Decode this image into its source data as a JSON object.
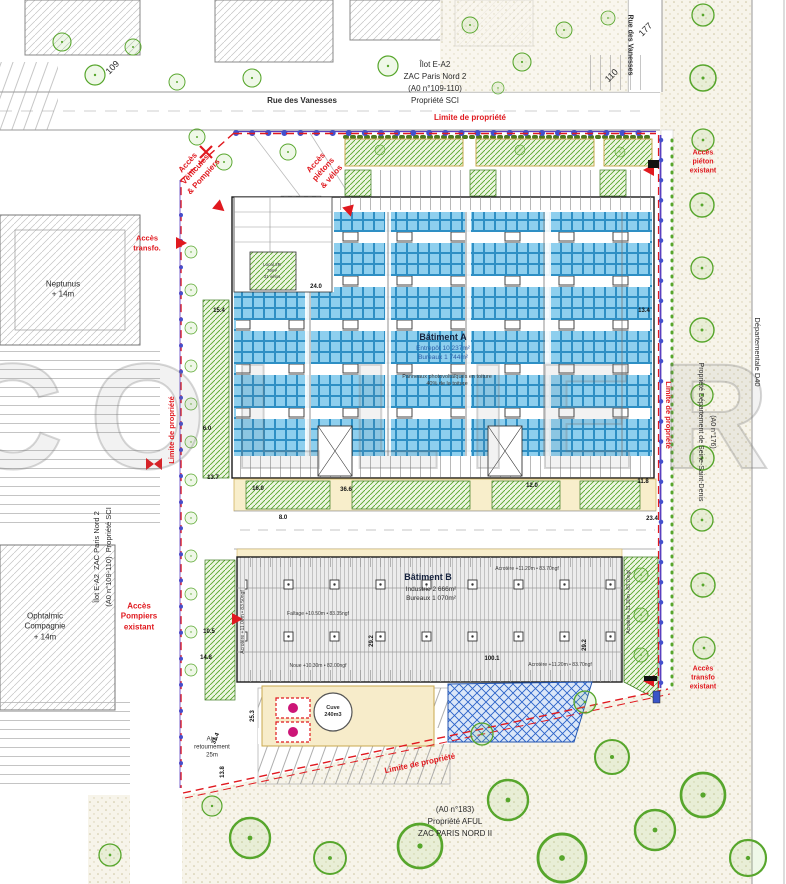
{
  "watermark": {
    "text": "COLLIERS ®"
  },
  "streets": {
    "rue_top": "Rue des Vanesses",
    "rue_right": "Rue des Vanesses",
    "departementale": "Départementale D40",
    "n109": "109",
    "n110": "110",
    "n177": "177"
  },
  "parcels": {
    "top": "Îlot E-A2\nZAC Paris Nord 2\n(A0 n°109-110)\nPropriété SCI",
    "left": "Îlot E-A2  ZAC Paris Nord 2\n(A0 n°109-110)  Propriété SCI",
    "right": "(A0 n°176)\nPropriété Département de Seine-Saint-Denis",
    "bottom": "(A0 n°183)\nPropriété AFUL\nZAC PARIS NORD II"
  },
  "limits": {
    "label": "Limite de propriété"
  },
  "access": {
    "vehicles": "Accès\nVéhicules\n& Pompiers",
    "pietons": "Accès\npiétons\n& vélos",
    "transfo": "Accès\ntransfo.",
    "pompiers": "Accès\nPompiers\nexistant",
    "pieton_existant": "Accès\npiéton\nexistant",
    "transfo_existant": "Accès\ntransfo\nexistant"
  },
  "context": {
    "neptunus": "Neptunus\n+ 14m",
    "ophtalmic": "Ophtalmic\nCompagnie\n+ 14m"
  },
  "building_a": {
    "name": "Bâtiment A",
    "line2": "Entrepôt 10 237m²",
    "line3": "Bureaux 1 744m²",
    "pv": "Panneaux photovoltaïques en toiture\n40% de la toiture"
  },
  "building_b": {
    "name": "Bâtiment B",
    "line2": "Industrie 2 666m²",
    "line3": "Bureaux 1 070m²"
  },
  "annotations": {
    "acrotere": "Acrotère +11.20m • 83.70ngf",
    "acrotere_left": "Acrotère +11.00m • 83.50ngf",
    "faitage": "Faîtage +10.50m • 83.35ngf",
    "noue": "Noue +10.30m • 82.00ngf"
  },
  "site": {
    "local_velos": "Local 2R\n79m²\n31 vélos",
    "aire": "Aire\nretournement\n25m",
    "cuve": "Cuve\n240m3"
  },
  "dims": {
    "v15_4": "15.4",
    "v13_4": "13.4",
    "v24_0": "24.0",
    "v6_0": "6.0",
    "v13_7": "13.7",
    "v16_0": "16.0",
    "v36_6": "36.6",
    "v12_0": "12.0",
    "v11_8": "11.8",
    "v8_0": "8.0",
    "v23_4": "23.4",
    "v10_5": "10.5",
    "v14_8": "14.8",
    "v29_2": "29.2",
    "v100_1": "100.1",
    "v31_4": "31.4",
    "v25_3": "25.3",
    "v13_8": "13.8"
  }
}
